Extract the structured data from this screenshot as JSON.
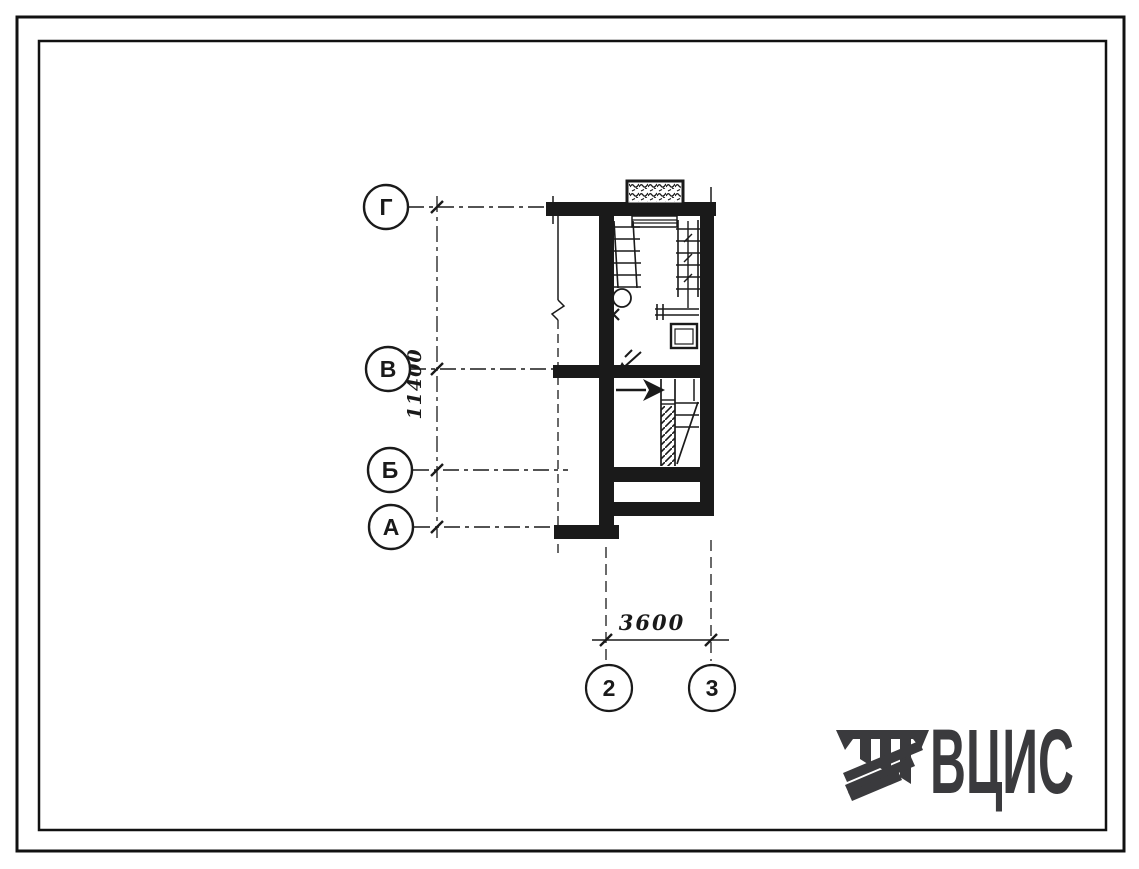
{
  "plan": {
    "row_axes": [
      {
        "label": "Г"
      },
      {
        "label": "В"
      },
      {
        "label": "Б"
      },
      {
        "label": "А"
      }
    ],
    "col_axes": [
      {
        "label": "2"
      },
      {
        "label": "3"
      }
    ],
    "dim_vertical": "11400",
    "dim_horizontal": "3600"
  },
  "logo": {
    "text": "ВЦИС"
  },
  "colors": {
    "ink": "#1a1a1a",
    "logo": "#3a3a3d",
    "paper": "#ffffff"
  }
}
